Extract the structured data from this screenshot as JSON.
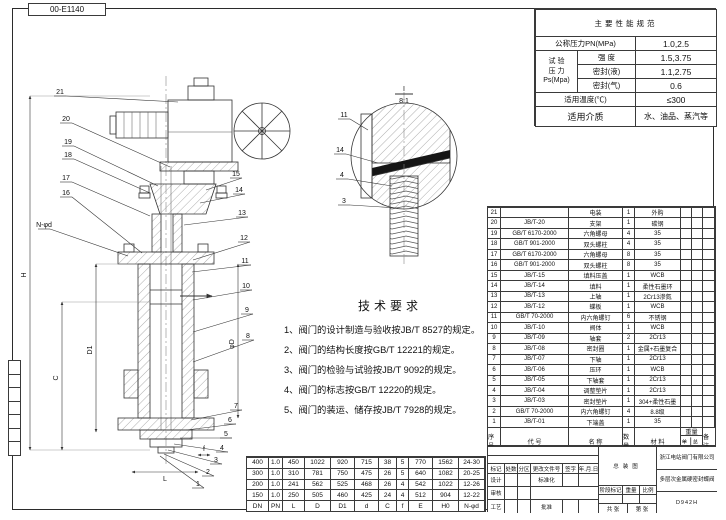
{
  "sheet": {
    "drawing_no": "00-E1140"
  },
  "spec_table": {
    "title": "主要性能规范",
    "nominal_pressure_label": "公称压力PN(MPa)",
    "nominal_pressure_value": "1.0,2.5",
    "test_label_1": "试 验",
    "test_label_2": "压 力",
    "test_label_3": "Ps(Mpa)",
    "strength_label": "强  度",
    "strength_value": "1.5,3.75",
    "seal_liquid_label": "密封(液)",
    "seal_liquid_value": "1.1,2.75",
    "seal_gas_label": "密封(气)",
    "seal_gas_value": "0.6",
    "temp_label": "适用温度(℃)",
    "temp_value": "≤300",
    "medium_label": "适用介质",
    "medium_value": "水、油品、蒸汽等"
  },
  "tech_requirements": {
    "title": "技术要求",
    "items": [
      "1、阀门的设计制造与验收按JB/T 8527的规定。",
      "2、阀门的结构长度按GB/T 12221的规定。",
      "3、阀门的检验与试验按JB/T 9092的规定。",
      "4、阀门的标志按GB/T 12220的规定。",
      "5、阀门的装运、储存按JB/T 7928的规定。"
    ]
  },
  "bom": {
    "header": {
      "no": "序号",
      "code": "代  号",
      "name": "名  称",
      "qty": "数量",
      "material": "材  料",
      "weight": "重量",
      "unit": "单件",
      "total": "总计",
      "remark": "备注"
    },
    "rows": [
      [
        "21",
        "",
        "电装",
        "1",
        "外购",
        "",
        "",
        ""
      ],
      [
        "20",
        "JB/T-20",
        "支架",
        "1",
        "碳钢",
        "",
        "",
        ""
      ],
      [
        "19",
        "GB/T 6170-2000",
        "六角螺母",
        "4",
        "35",
        "",
        "",
        ""
      ],
      [
        "18",
        "GB/T 901-2000",
        "双头螺柱",
        "4",
        "35",
        "",
        "",
        ""
      ],
      [
        "17",
        "GB/T 6170-2000",
        "六角螺母",
        "8",
        "35",
        "",
        "",
        ""
      ],
      [
        "16",
        "GB/T 901-2000",
        "双头螺柱",
        "8",
        "35",
        "",
        "",
        ""
      ],
      [
        "15",
        "JB/T-15",
        "填料压盖",
        "1",
        "WCB",
        "",
        "",
        ""
      ],
      [
        "14",
        "JB/T-14",
        "填料",
        "1",
        "柔性石墨环",
        "",
        "",
        ""
      ],
      [
        "13",
        "JB/T-13",
        "上轴",
        "1",
        "2Cr13渗氮",
        "",
        "",
        ""
      ],
      [
        "12",
        "JB/T-12",
        "蝶板",
        "1",
        "WCB",
        "",
        "",
        ""
      ],
      [
        "11",
        "GB/T 70-2000",
        "内六角螺钉",
        "6",
        "不锈钢",
        "",
        "",
        ""
      ],
      [
        "10",
        "JB/T-10",
        "阀体",
        "1",
        "WCB",
        "",
        "",
        ""
      ],
      [
        "9",
        "JB/T-09",
        "轴套",
        "2",
        "2Cr13",
        "",
        "",
        ""
      ],
      [
        "8",
        "JB/T-08",
        "密封圈",
        "1",
        "金属+石墨复合",
        "",
        "",
        ""
      ],
      [
        "7",
        "JB/T-07",
        "下轴",
        "1",
        "2Cr13",
        "",
        "",
        ""
      ],
      [
        "6",
        "JB/T-06",
        "压环",
        "1",
        "WCB",
        "",
        "",
        ""
      ],
      [
        "5",
        "JB/T-05",
        "下轴套",
        "1",
        "2Cr13",
        "",
        "",
        ""
      ],
      [
        "4",
        "JB/T-04",
        "调整垫片",
        "1",
        "2Cr13",
        "",
        "",
        ""
      ],
      [
        "3",
        "JB/T-03",
        "密封垫片",
        "1",
        "304+柔性石墨",
        "",
        "",
        ""
      ],
      [
        "2",
        "GB/T 70-2000",
        "内六角螺钉",
        "4",
        "8.8级",
        "",
        "",
        ""
      ],
      [
        "1",
        "JB/T-01",
        "下端盖",
        "1",
        "35",
        "",
        "",
        ""
      ]
    ]
  },
  "dim_table": {
    "headers": [
      "DN",
      "PN",
      "L",
      "D",
      "D1",
      "d",
      "C",
      "f",
      "E",
      "H0",
      "N-φd"
    ],
    "rows": [
      [
        "400",
        "1.0",
        "450",
        "1022",
        "920",
        "715",
        "38",
        "5",
        "770",
        "1562",
        "24-30"
      ],
      [
        "300",
        "1.0",
        "310",
        "781",
        "750",
        "475",
        "26",
        "5",
        "640",
        "1082",
        "20-25"
      ],
      [
        "200",
        "1.0",
        "241",
        "562",
        "525",
        "468",
        "26",
        "4",
        "542",
        "1022",
        "12-26"
      ],
      [
        "150",
        "1.0",
        "250",
        "505",
        "460",
        "425",
        "24",
        "4",
        "512",
        "904",
        "12-22"
      ]
    ]
  },
  "title_block": {
    "drawing_title": "总装图",
    "company": "浙江电站阀门有限公司",
    "product_name": "多层次金属硬密封蝶阀",
    "model": "D942H",
    "mark_label": "标记",
    "count_label": "处数",
    "zone_label": "分区",
    "change_doc_label": "更改文件号",
    "sign_label": "签字",
    "date_label": "年.月.日",
    "design_label": "设计",
    "standard_label": "标准化",
    "stage_label": "阶段标记",
    "weight_label": "重量",
    "scale_label": "比例",
    "review_label": "审核",
    "process_label": "工艺",
    "approve_label": "批准",
    "sheets_label": "共  张",
    "page_label": "第  张"
  },
  "drawing": {
    "flow_note": "",
    "callouts": [
      {
        "n": "21",
        "x": 60,
        "y": 94,
        "tx": 178,
        "ty": 102
      },
      {
        "n": "20",
        "x": 66,
        "y": 121,
        "tx": 170,
        "ty": 167
      },
      {
        "n": "19",
        "x": 68,
        "y": 144,
        "tx": 158,
        "ty": 186
      },
      {
        "n": "18",
        "x": 68,
        "y": 157,
        "tx": 150,
        "ty": 193
      },
      {
        "n": "17",
        "x": 66,
        "y": 180,
        "tx": 150,
        "ty": 216
      },
      {
        "n": "16",
        "x": 66,
        "y": 195,
        "tx": 142,
        "ty": 253
      },
      {
        "n": "N-φd",
        "x": 44,
        "y": 227,
        "tx": 128,
        "ty": 256
      },
      {
        "n": "15",
        "x": 236,
        "y": 176,
        "tx": 206,
        "ty": 190
      },
      {
        "n": "14",
        "x": 239,
        "y": 192,
        "tx": 200,
        "ty": 203
      },
      {
        "n": "13",
        "x": 242,
        "y": 215,
        "tx": 184,
        "ty": 225
      },
      {
        "n": "12",
        "x": 244,
        "y": 240,
        "tx": 193,
        "ty": 260
      },
      {
        "n": "11",
        "x": 245,
        "y": 263,
        "tx": 192,
        "ty": 272
      },
      {
        "n": "10",
        "x": 246,
        "y": 288,
        "tx": 193,
        "ty": 300
      },
      {
        "n": "9",
        "x": 247,
        "y": 312,
        "tx": 193,
        "ty": 332
      },
      {
        "n": "8",
        "x": 248,
        "y": 338,
        "tx": 193,
        "ty": 362
      },
      {
        "n": "7",
        "x": 236,
        "y": 408,
        "tx": 191,
        "ty": 420
      },
      {
        "n": "6",
        "x": 230,
        "y": 422,
        "tx": 186,
        "ty": 430
      },
      {
        "n": "5",
        "x": 226,
        "y": 436,
        "tx": 180,
        "ty": 438
      },
      {
        "n": "4",
        "x": 222,
        "y": 450,
        "tx": 174,
        "ty": 444
      },
      {
        "n": "3",
        "x": 216,
        "y": 462,
        "tx": 168,
        "ty": 450
      },
      {
        "n": "2",
        "x": 208,
        "y": 474,
        "tx": 164,
        "ty": 454
      },
      {
        "n": "1",
        "x": 198,
        "y": 486,
        "tx": 160,
        "ty": 456
      }
    ],
    "detail": {
      "label": "I",
      "scale": "8:1",
      "lx": 404,
      "ly": 91,
      "callouts": [
        {
          "n": "11",
          "x": 344,
          "y": 117,
          "tx": 368,
          "ty": 130
        },
        {
          "n": "14",
          "x": 340,
          "y": 152,
          "tx": 378,
          "ty": 163
        },
        {
          "n": "4",
          "x": 342,
          "y": 177,
          "tx": 392,
          "ty": 186
        },
        {
          "n": "3",
          "x": 344,
          "y": 203,
          "tx": 398,
          "ty": 208
        }
      ]
    },
    "dims": [
      {
        "label": "H",
        "x1": 30,
        "y1": 96,
        "x2": 30,
        "y2": 450,
        "lx": 26,
        "ly": 275,
        "rot": -90
      },
      {
        "label": "C",
        "x1": 62,
        "y1": 302,
        "x2": 62,
        "y2": 450,
        "lx": 58,
        "ly": 378,
        "rot": -90
      },
      {
        "label": "D1",
        "x1": 96,
        "y1": 264,
        "x2": 96,
        "y2": 432,
        "lx": 92,
        "ly": 350,
        "rot": -90
      },
      {
        "label": "φD",
        "x1": 238,
        "y1": 264,
        "x2": 238,
        "y2": 418,
        "lx": 234,
        "ly": 344,
        "rot": -90
      },
      {
        "label": "L",
        "x1": 132,
        "y1": 472,
        "x2": 198,
        "y2": 472,
        "lx": 165,
        "ly": 481
      },
      {
        "label": "f",
        "x1": 198,
        "y1": 455,
        "x2": 210,
        "y2": 455,
        "lx": 204,
        "ly": 451
      }
    ]
  }
}
